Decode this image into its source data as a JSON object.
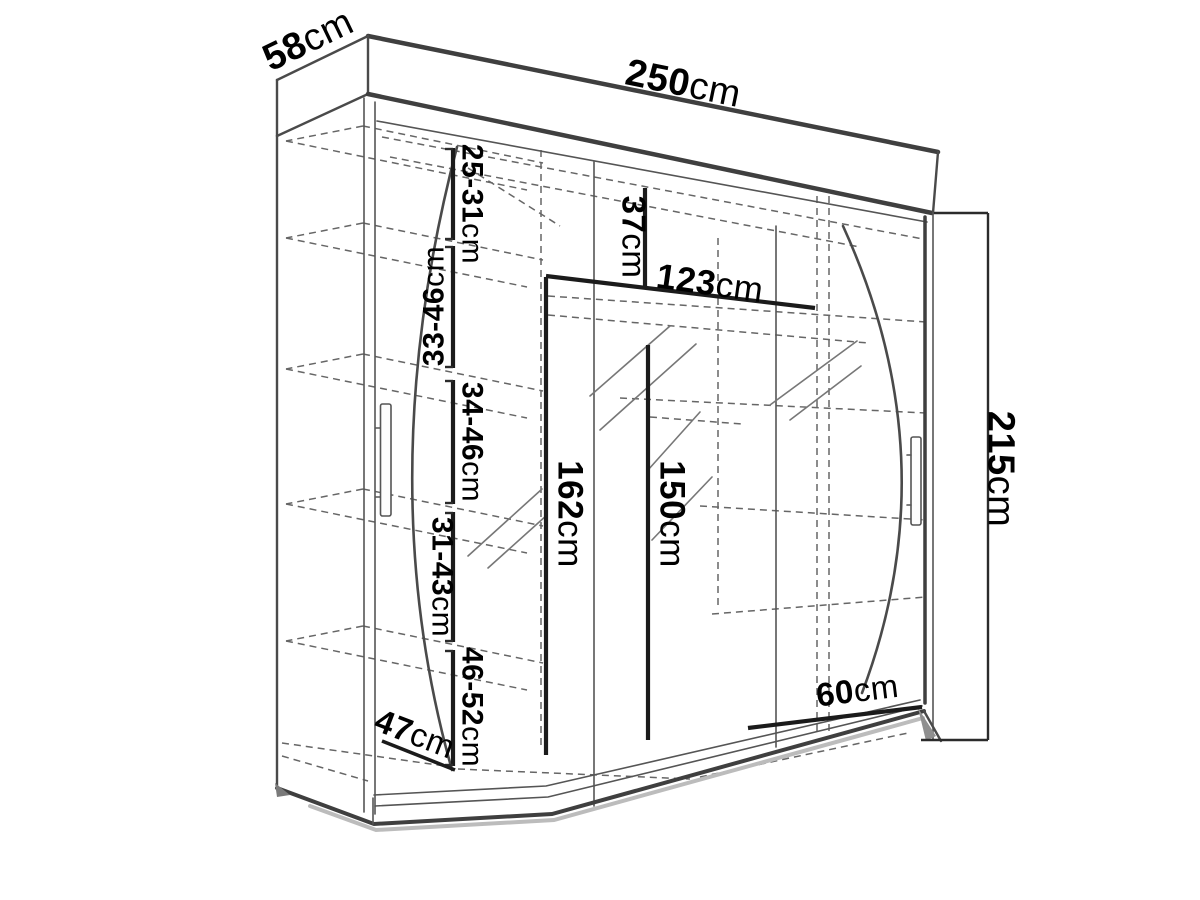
{
  "diagram": {
    "subject": "wardrobe-dimension-drawing",
    "colors": {
      "background": "#ffffff",
      "line": "#4a4a4a",
      "dimension_line": "#1b1b1b",
      "text": "#000000"
    },
    "dims": {
      "d58": {
        "value": "58",
        "unit": "cm"
      },
      "d250": {
        "value": "250",
        "unit": "cm"
      },
      "d215": {
        "value": "215",
        "unit": "cm"
      },
      "d25_31": {
        "value": "25-31",
        "unit": "cm"
      },
      "d33_46": {
        "value": "33-46",
        "unit": "cm"
      },
      "d34_46": {
        "value": "34-46",
        "unit": "cm"
      },
      "d31_43": {
        "value": "31-43",
        "unit": "cm"
      },
      "d46_52": {
        "value": "46-52",
        "unit": "cm"
      },
      "d37": {
        "value": "37",
        "unit": "cm"
      },
      "d123": {
        "value": "123",
        "unit": "cm"
      },
      "d162": {
        "value": "162",
        "unit": "cm"
      },
      "d150": {
        "value": "150",
        "unit": "cm"
      },
      "d60": {
        "value": "60",
        "unit": "cm"
      },
      "d47": {
        "value": "47",
        "unit": "cm"
      }
    }
  }
}
